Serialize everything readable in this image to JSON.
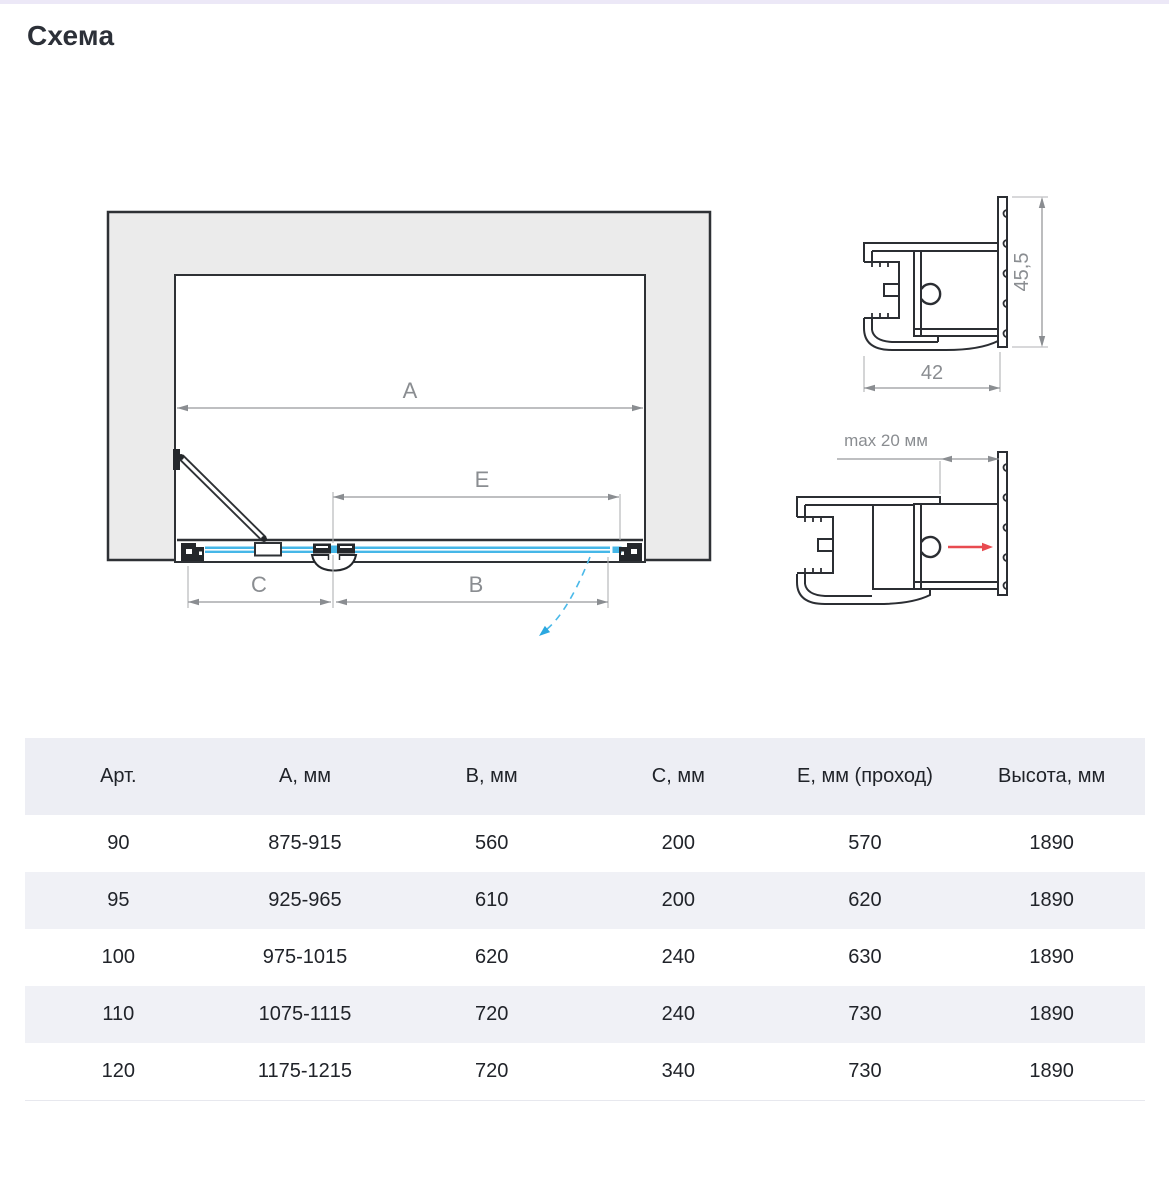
{
  "page": {
    "title": "Схема"
  },
  "diagram": {
    "main_view": {
      "dim_a": "A",
      "dim_e": "E",
      "dim_c": "C",
      "dim_b": "B"
    },
    "profile_top": {
      "height_dim": "45,5",
      "width_dim": "42"
    },
    "profile_bottom": {
      "gap_dim": "max 20 мм"
    },
    "colors": {
      "wall_fill": "#ebebeb",
      "outline": "#2b2e33",
      "glass_blue": "#45b7e8",
      "dimension_gray": "#8a8d91",
      "arrow_red": "#e84b50"
    }
  },
  "table": {
    "headers": [
      "Арт.",
      "А, мм",
      "В, мм",
      "С, мм",
      "Е, мм (проход)",
      "Высота, мм"
    ],
    "rows": [
      [
        "90",
        "875-915",
        "560",
        "200",
        "570",
        "1890"
      ],
      [
        "95",
        "925-965",
        "610",
        "200",
        "620",
        "1890"
      ],
      [
        "100",
        "975-1015",
        "620",
        "240",
        "630",
        "1890"
      ],
      [
        "110",
        "1075-1115",
        "720",
        "240",
        "730",
        "1890"
      ],
      [
        "120",
        "1175-1215",
        "720",
        "340",
        "730",
        "1890"
      ]
    ]
  }
}
